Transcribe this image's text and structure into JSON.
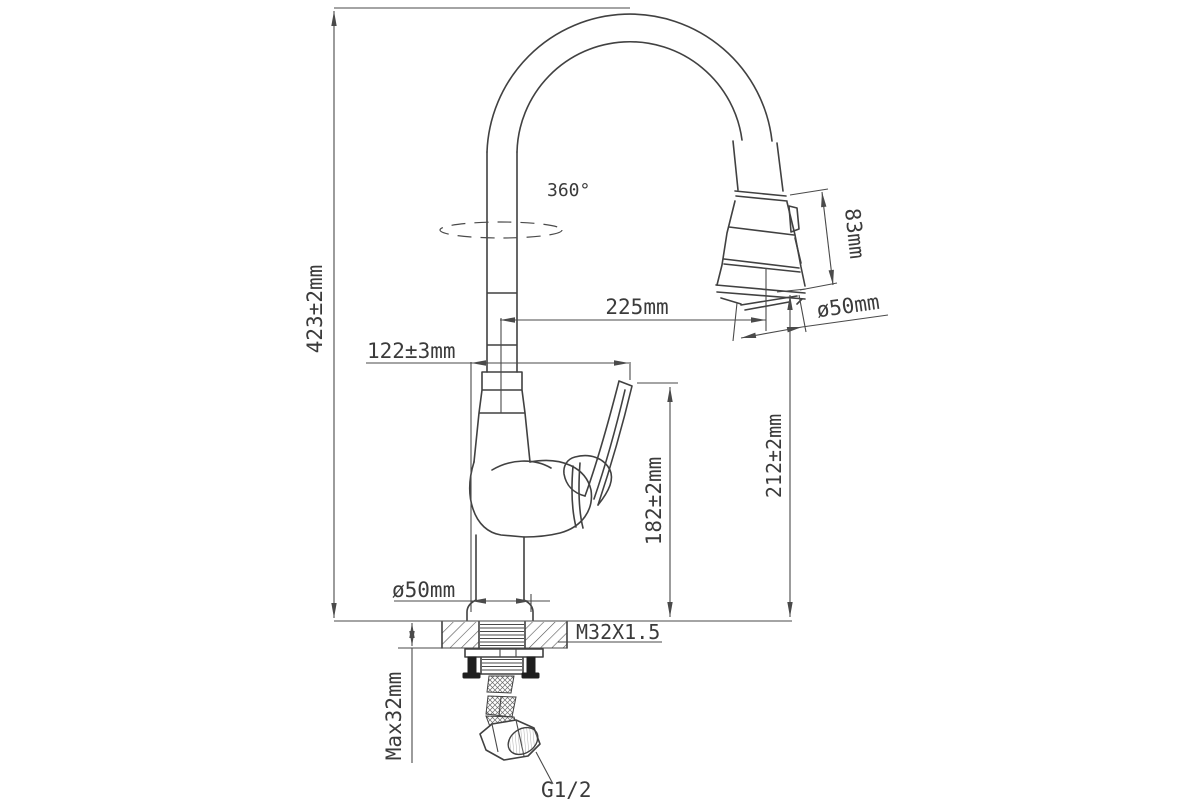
{
  "drawing": {
    "type": "technical-dimension-drawing",
    "subject": "kitchen pull-out faucet side view with mounting hardware",
    "colors": {
      "line": "#414141",
      "dimension_line": "#4a4a4a",
      "text": "#3b3b3b",
      "background": "#ffffff"
    },
    "labels": {
      "total_height": "423±2mm",
      "swivel_rotation": "360°",
      "spray_head_length": "83mm",
      "spout_reach": "225mm",
      "spray_head_diameter": "ø50mm",
      "spout_offset": "122±3mm",
      "height_to_spray_outlet": "212±2mm",
      "height_to_handle_top": "182±2mm",
      "base_diameter": "ø50mm",
      "mounting_thread": "M32X1.5",
      "max_deck_thickness": "Max32mm",
      "supply_connection": "G1/2"
    }
  }
}
